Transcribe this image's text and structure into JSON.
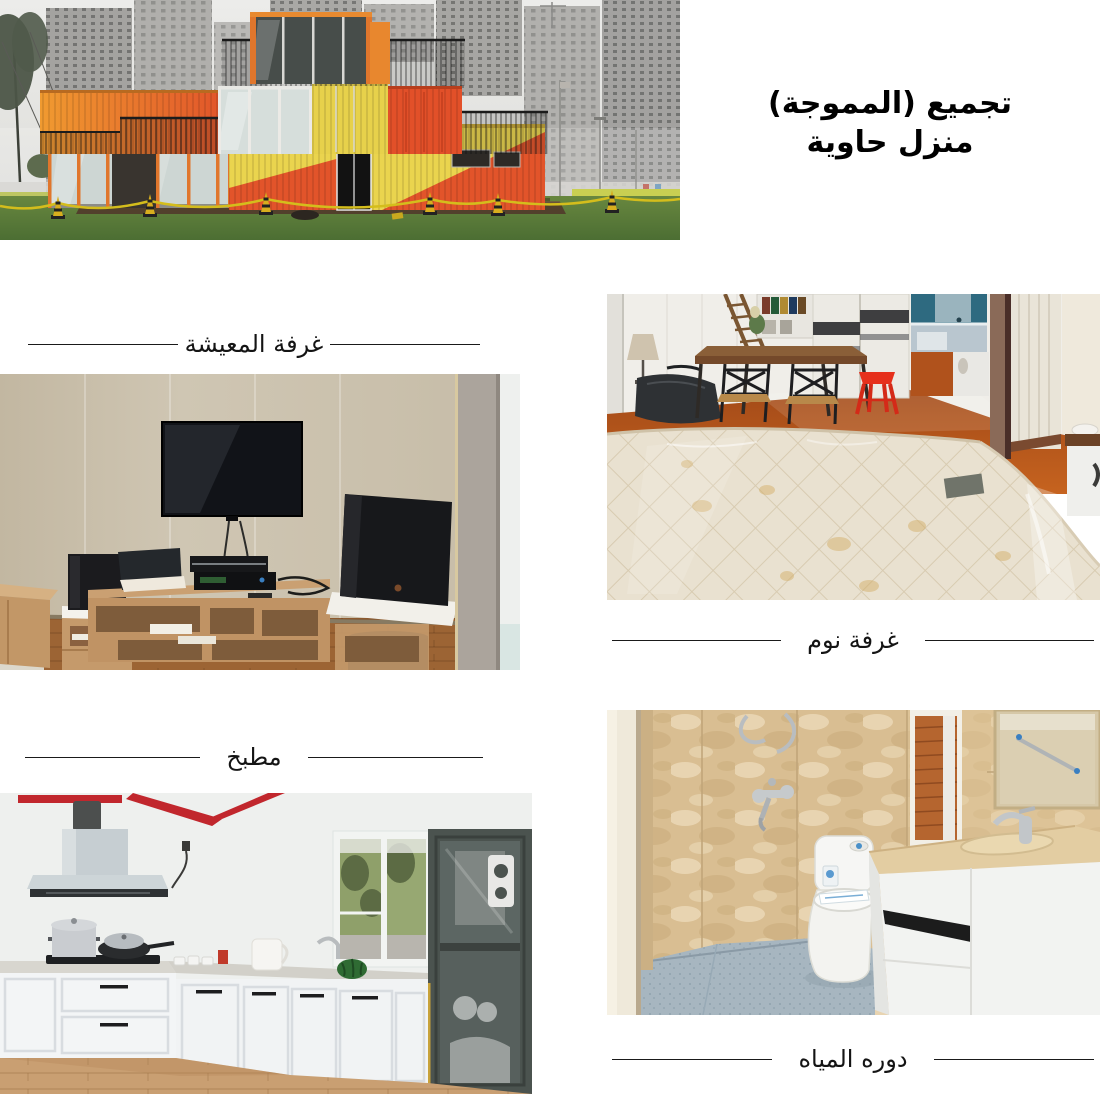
{
  "page": {
    "width": 1100,
    "height": 1094,
    "background": "#ffffff"
  },
  "title": {
    "line1": "تجميع (المموجة)",
    "line2": "منزل حاوية",
    "color": "#000000"
  },
  "sections": {
    "living_room": {
      "label": "غرفة المعيشة"
    },
    "bedroom": {
      "label": "غرفة نوم"
    },
    "kitchen": {
      "label": "مطبخ"
    },
    "bathroom": {
      "label": "دوره المياه"
    }
  },
  "photos": {
    "hero": {
      "subject": "container house of stacked orange, yellow and red shipping containers with glass walls, rooftop railings, lawn with yellow caution tape and hazy high-rise towers behind"
    },
    "living_room": {
      "subject": "living room with wall-mounted TV, light-wood media stand, AV gear and two black speakers on white foam, beige panelled walls"
    },
    "bedroom": {
      "subject": "plastic-wrapped quilted mattress in front of wooden dining set, ladder, sliding wardrobe, red stool and kitchenette"
    },
    "kitchen": {
      "subject": "white L-shaped kitchen with range hood, pots on stove, window to trees, dark display cabinet and red ceiling beams"
    },
    "bathroom": {
      "subject": "beige marble-tiled bathroom with shower fittings, toilet, white vanity with sink, mirror and small window"
    }
  },
  "colors": {
    "container_orange": "#e8872e",
    "container_red": "#e2542a",
    "container_yellow": "#ead44e",
    "caution_yellow": "#d4bd1c",
    "lawn_green": "#5d7f3e",
    "beam_red": "#c1272d",
    "stool_red": "#e6301c",
    "wall_beige": "#cbc2ae",
    "tile_beige": "#d9be92",
    "mattress_cream": "#e9e1d0",
    "divider_line": "#1a1a1a"
  }
}
